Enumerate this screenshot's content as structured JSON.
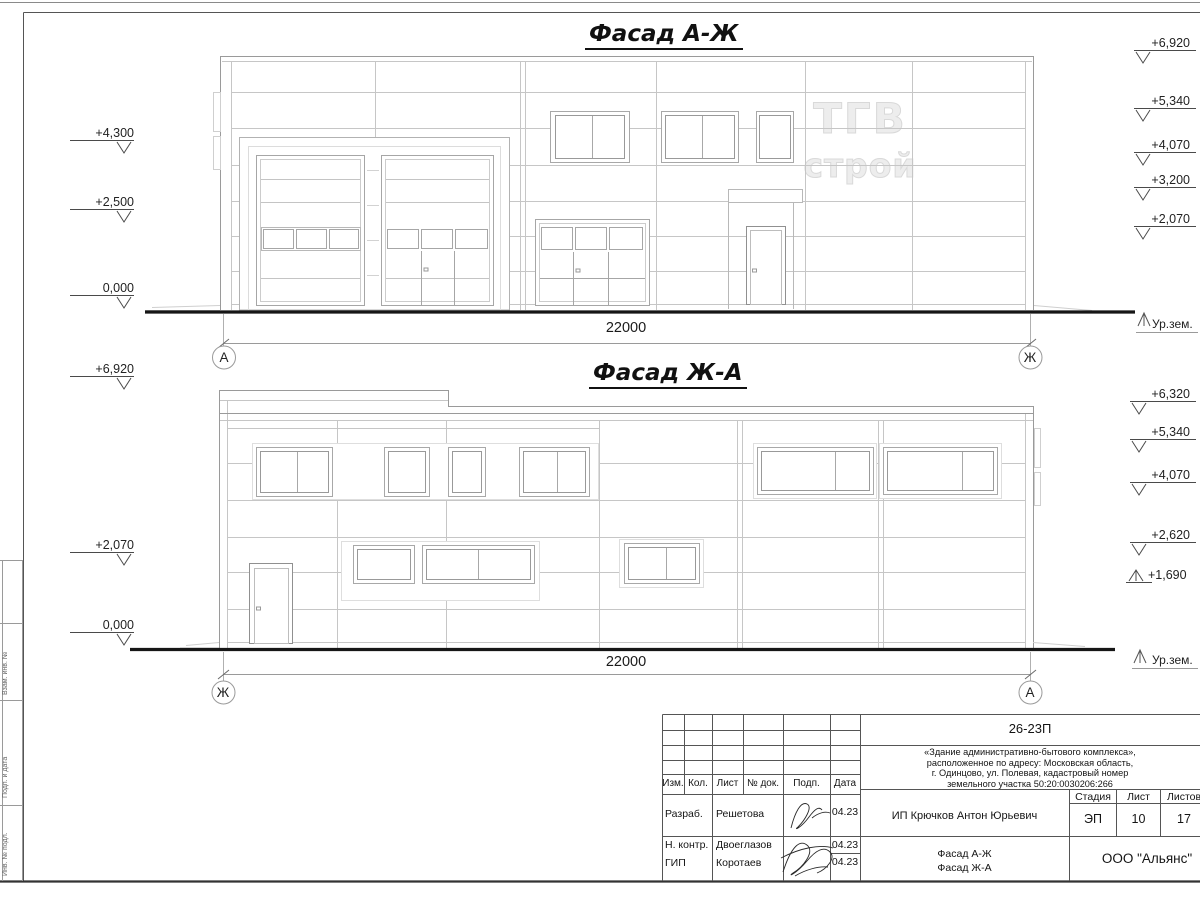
{
  "sheet": {
    "facade1": {
      "title": "Фасад А-Ж",
      "axis_left": "А",
      "axis_right": "Ж",
      "dimension": "22000",
      "ground_label": "Ур.зем.",
      "marks_left": [
        "+4,300",
        "+2,500",
        "0,000"
      ],
      "marks_right": [
        "+6,920",
        "+5,340",
        "+4,070",
        "+3,200",
        "+2,070"
      ],
      "watermark": {
        "line1": "ТГВ",
        "line2": "строй"
      }
    },
    "facade2": {
      "title": "Фасад Ж-А",
      "axis_left": "Ж",
      "axis_right": "А",
      "dimension": "22000",
      "ground_label": "Ур.зем.",
      "marks_left": [
        "+6,920",
        "+2,070",
        "0,000"
      ],
      "marks_right": [
        "+6,320",
        "+5,340",
        "+4,070",
        "+2,620",
        "+1,690"
      ]
    },
    "side_strip": {
      "labels": [
        "Взам. инв. №",
        "Подп. и дата",
        "Инв. № подл."
      ]
    },
    "title_block": {
      "doc_number": "26-23П",
      "description_lines": [
        "«Здание административно-бытового комплекса»,",
        "расположенное по адресу: Московская область,",
        "г. Одинцово, ул. Полевая, кадастровый номер",
        "земельного участка 50:20:0030206:266"
      ],
      "columns": [
        "Изм.",
        "Кол.",
        "Лист",
        "№ док.",
        "Подп.",
        "Дата"
      ],
      "rows": [
        {
          "role": "Разраб.",
          "name": "Решетова",
          "date": "04.23"
        },
        {
          "role": "Н. контр.",
          "name": "Двоеглазов",
          "date": "04.23"
        },
        {
          "role": "ГИП",
          "name": "Коротаев",
          "date": "04.23"
        }
      ],
      "client": "ИП Крючков Антон Юрьевич",
      "stage_label": "Стадия",
      "sheet_label": "Лист",
      "sheets_label": "Листов",
      "stage": "ЭП",
      "sheet_number": "10",
      "sheets_total": "17",
      "drawing_title_line1": "Фасад А-Ж",
      "drawing_title_line2": "Фасад Ж-А",
      "organization": "ООО \"Альянс\""
    }
  }
}
